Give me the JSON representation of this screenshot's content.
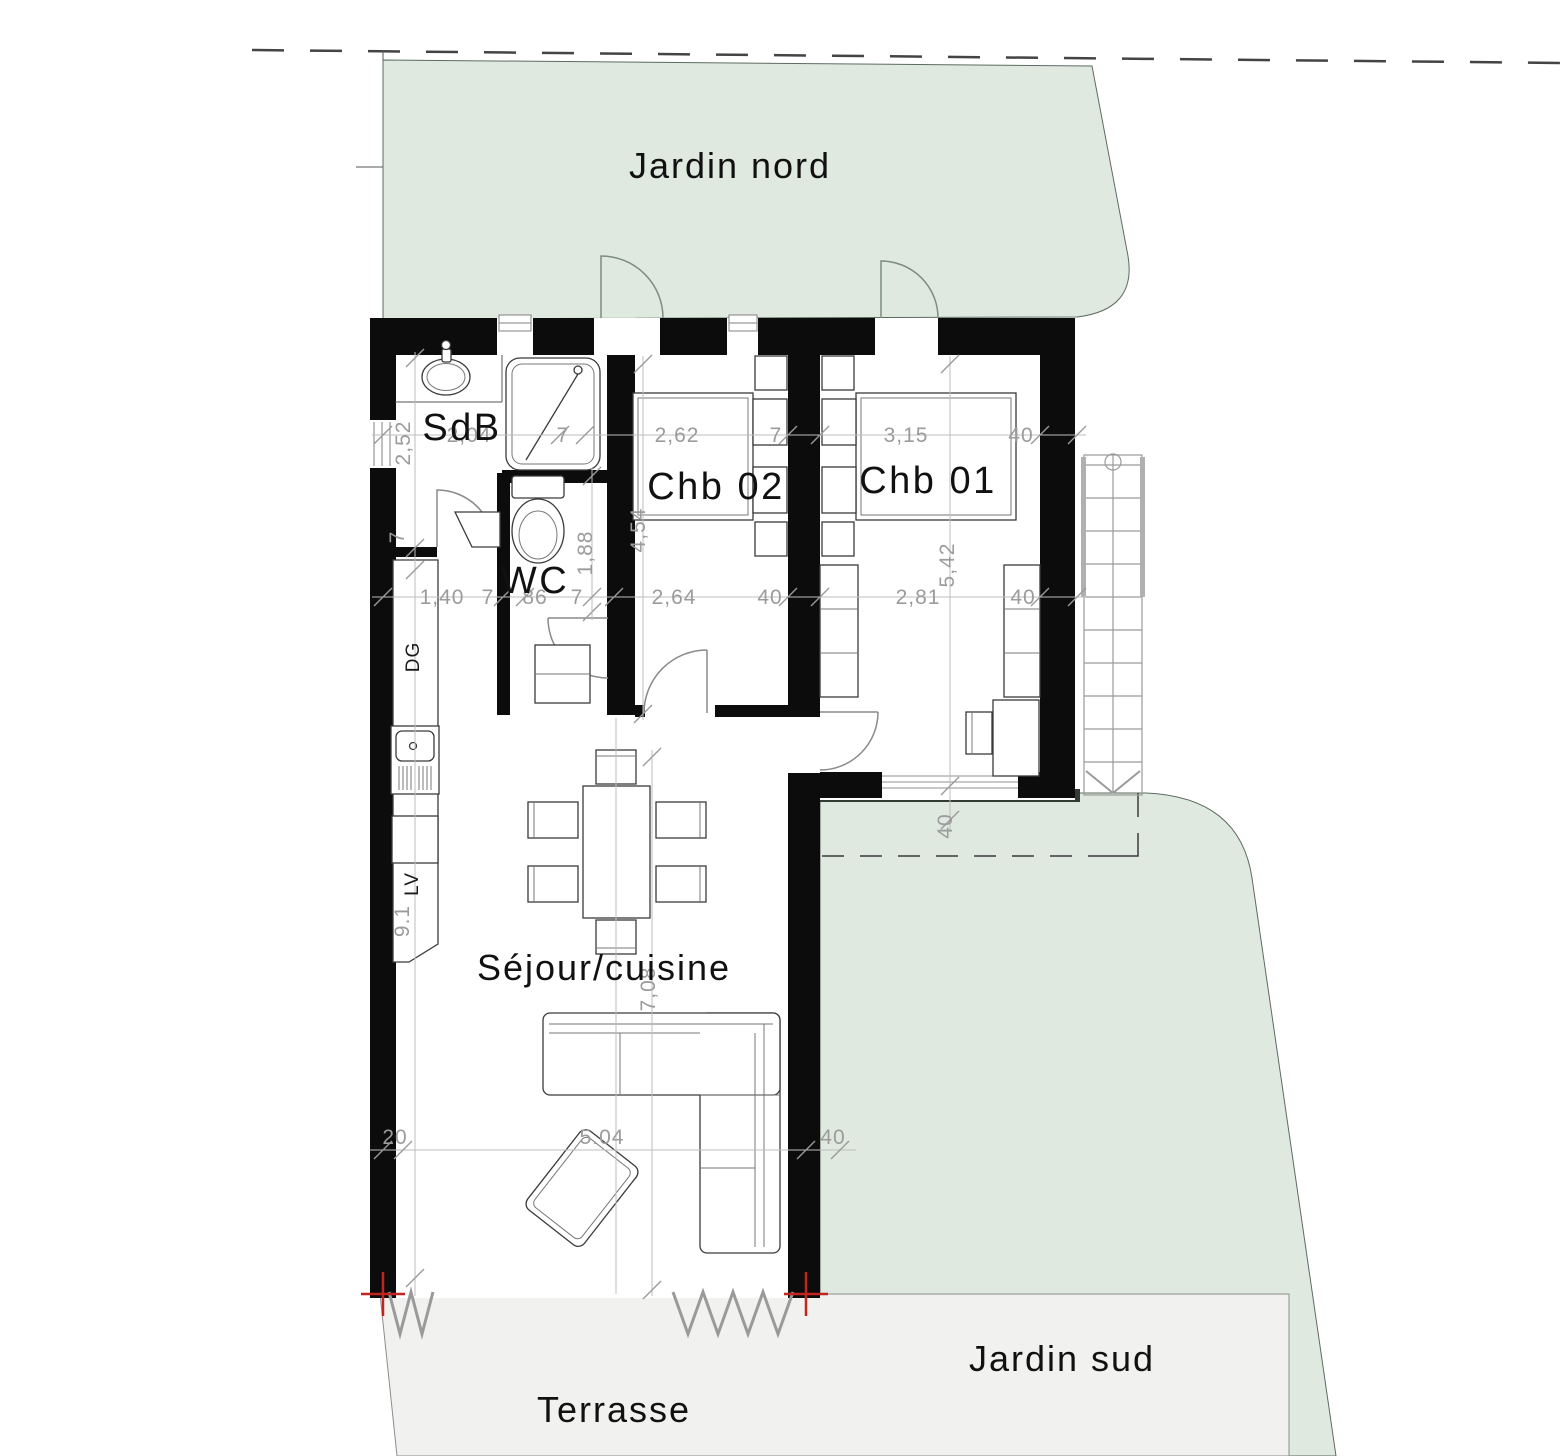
{
  "site": {
    "garden_north_label": "Jardin nord",
    "garden_south_label": "Jardin sud",
    "terrace_label": "Terrasse"
  },
  "rooms": {
    "bathroom_label": "SdB",
    "wc_label": "WC",
    "bedroom2_label": "Chb 02",
    "bedroom1_label": "Chb 01",
    "living_label": "Séjour/cuisine"
  },
  "kitchen": {
    "dg_label": "DG",
    "lv_label": "LV"
  },
  "dimensions": {
    "top_line": [
      "2,04",
      "7",
      "2,62",
      "7",
      "3,15",
      "40"
    ],
    "mid_line": [
      "1,40",
      "7",
      "86",
      "7",
      "2,64",
      "40",
      "2,81",
      "40"
    ],
    "bottom_line": [
      "20",
      "5.04",
      "40"
    ],
    "vertical": [
      "2,52",
      "7",
      "1,88",
      "4,54",
      "5,42",
      "40",
      "9.1",
      "7,08"
    ]
  },
  "colors": {
    "garden": "#dfe9e0",
    "garden_edge": "#5c6c60",
    "terrace": "#f1f1f0",
    "wall": "#0c0c0c",
    "dimension_text": "#9b9b9b",
    "survey_mark_red": "#c0251f"
  }
}
